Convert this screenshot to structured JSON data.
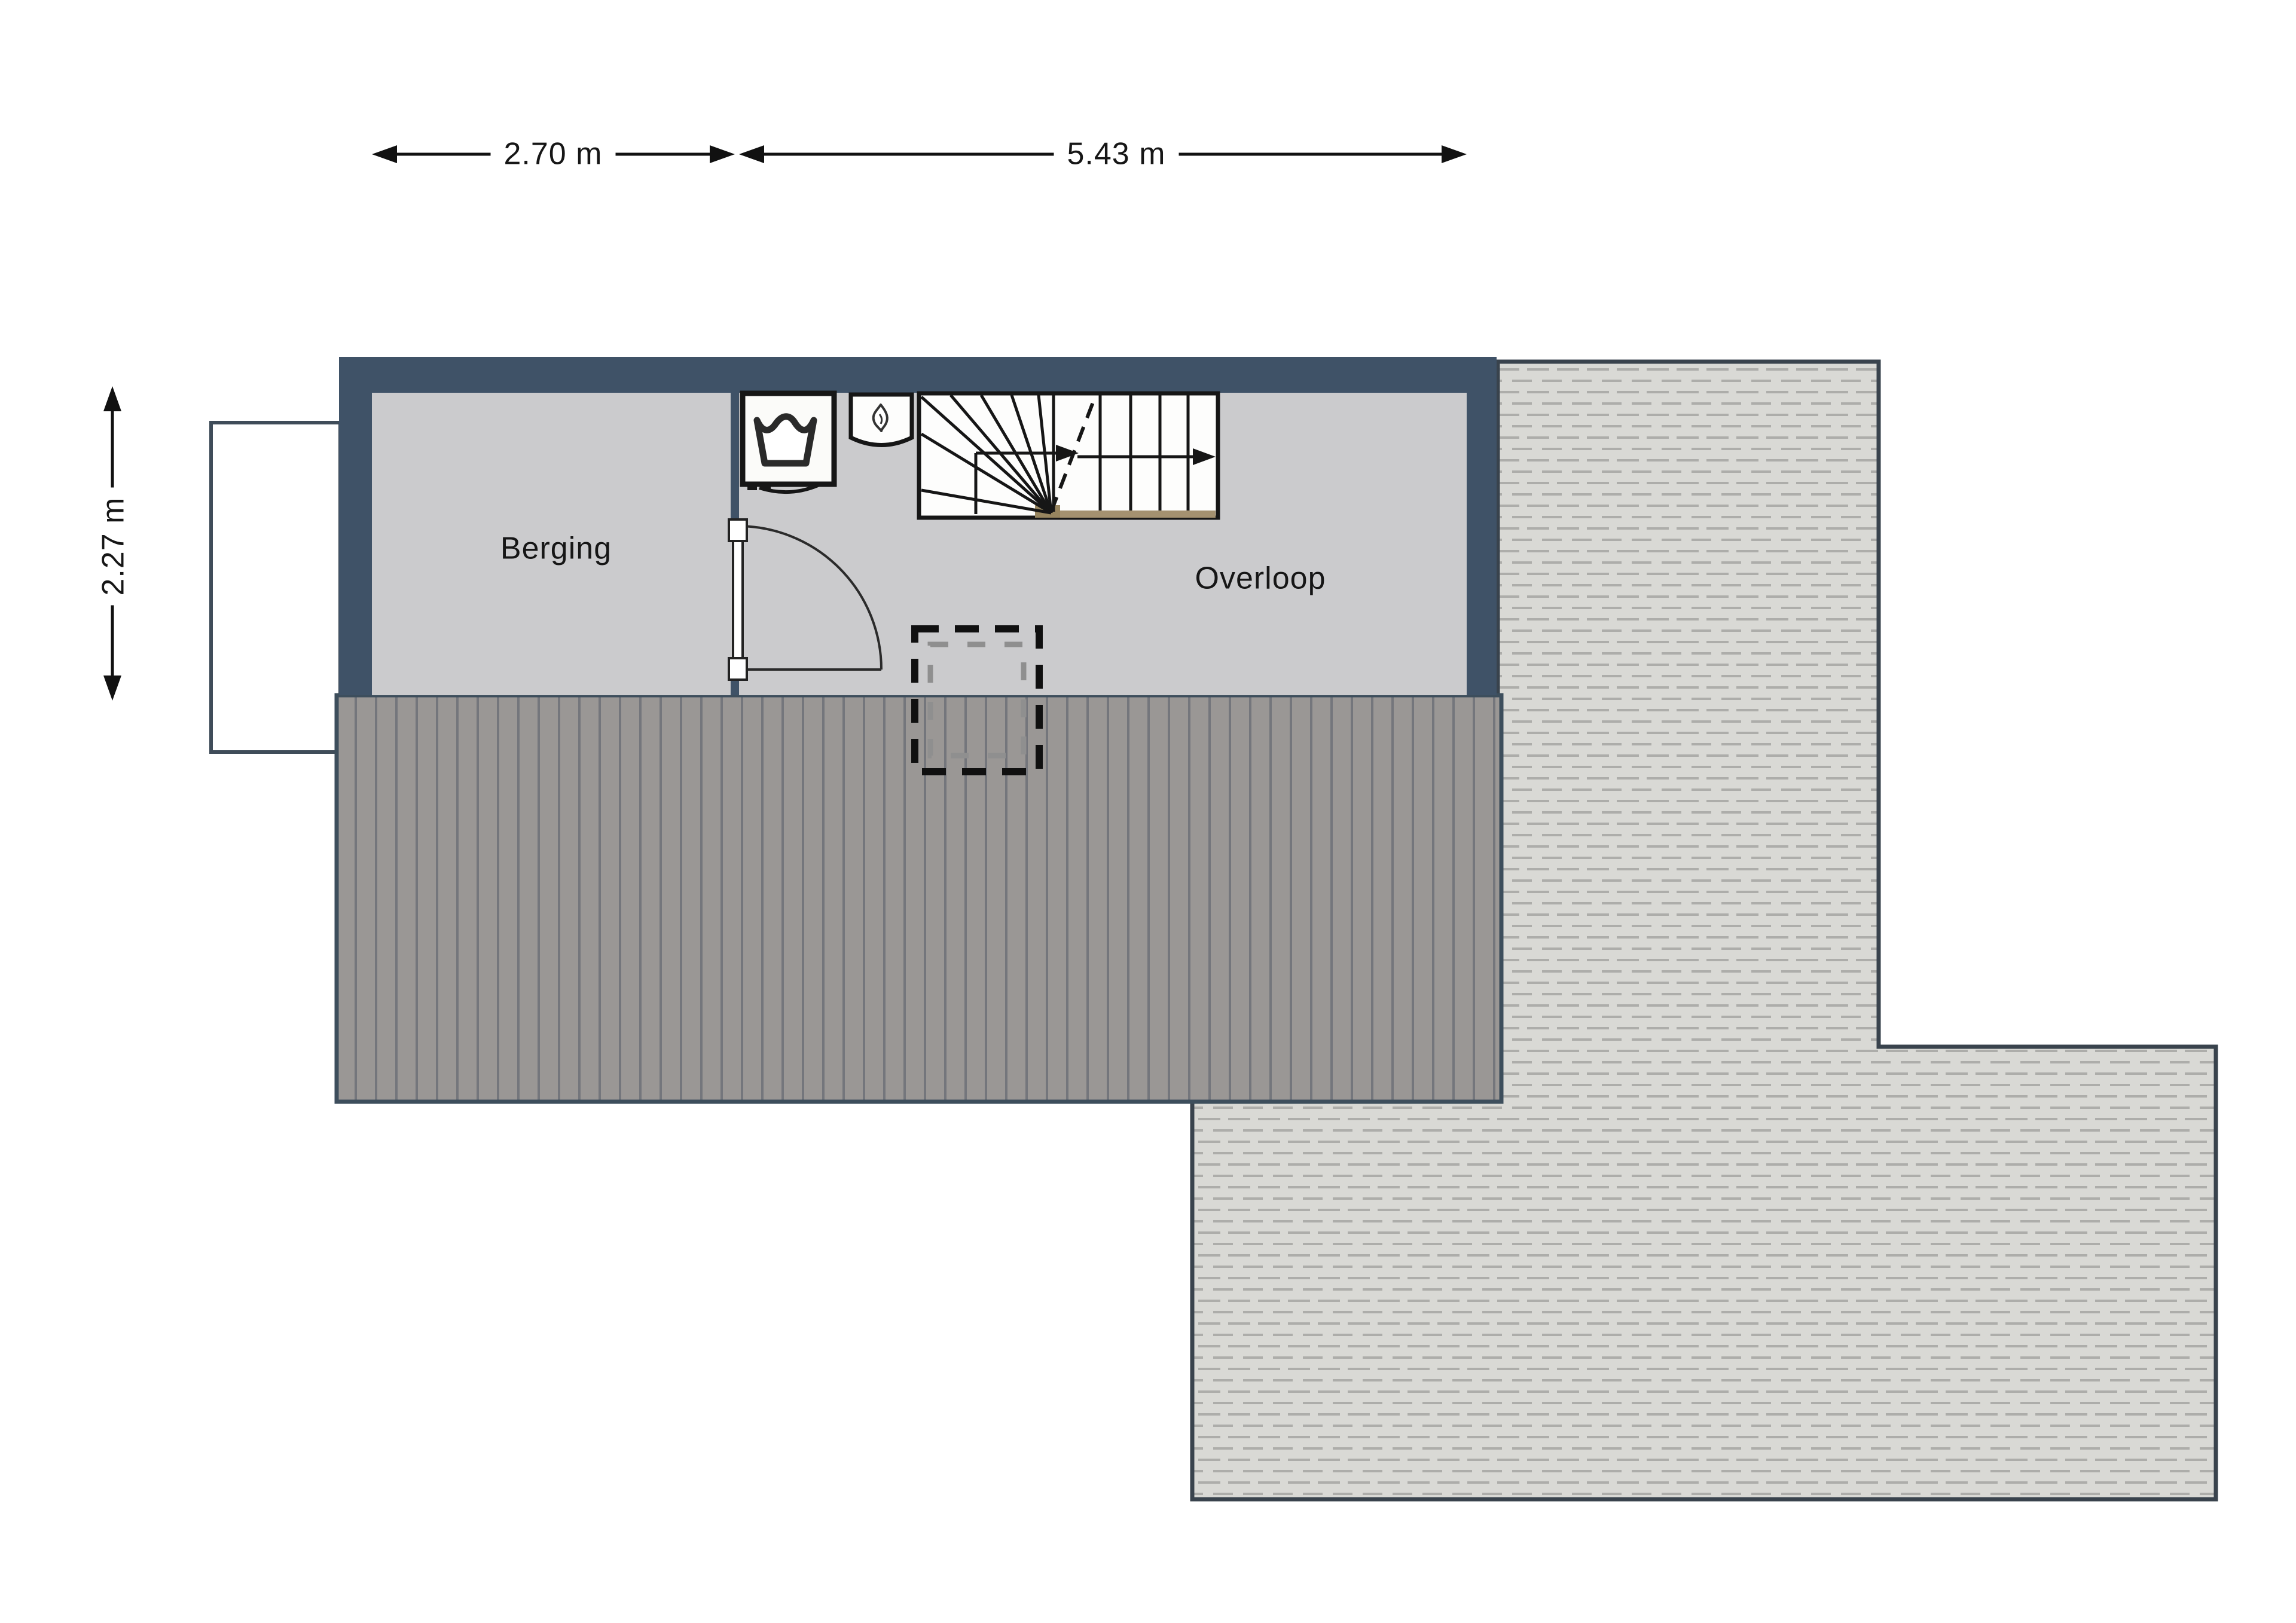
{
  "plan": {
    "type_label": "floor-plan",
    "dimension_top_left": "2.70 m",
    "dimension_top_right": "5.43 m",
    "dimension_side_left": "2.27 m",
    "room_left": "Berging",
    "room_right": "Overloop"
  },
  "icons": {
    "washing_machine": "washing-machine-icon",
    "water_heater": "water-heater-flame-icon",
    "staircase": "staircase-with-walkline-arrow",
    "door": "door-swing-arc",
    "skylight": "dashed-opening-marker",
    "dormer": "dormer-outline"
  },
  "colors": {
    "wall": "#3f5267",
    "floor": "#cbcbcd",
    "roof_dark": "#9a9795",
    "roof_dark_stripe": "#74767c",
    "roof_light": "#d9d9d5",
    "roof_light_dash": "#adadaa",
    "stair_wood": "#a49170",
    "line": "#161616",
    "dimension_text": "#161616"
  }
}
